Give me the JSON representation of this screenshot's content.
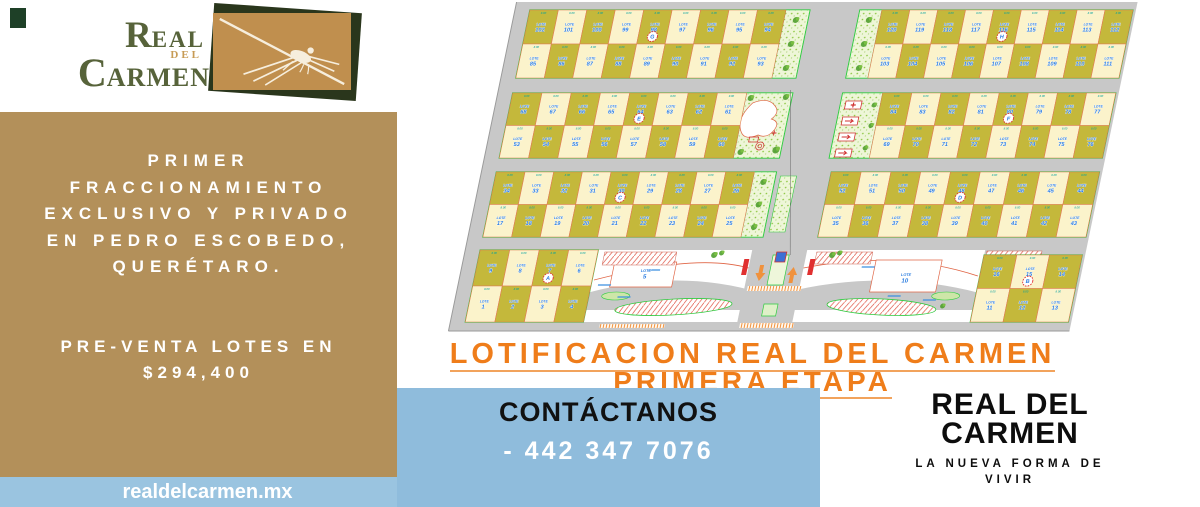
{
  "logo": {
    "line1_initial": "R",
    "line1_rest": "EAL",
    "del": "DEL",
    "line2_initial": "C",
    "line2_rest": "ARMEN"
  },
  "left_panel": {
    "headline": [
      "PRIMER",
      "FRACCIONAMIENTO",
      "EXCLUSIVO Y PRIVADO",
      "EN PEDRO ESCOBEDO,",
      "QUERÉTARO."
    ],
    "presale": [
      "PRE-VENTA LOTES EN",
      "$294,400"
    ]
  },
  "website": "realdelcarmen.mx",
  "plan_title": {
    "line1": "LOTIFICACION REAL DEL CARMEN",
    "line2": "PRIMERA ETAPA"
  },
  "contact": {
    "heading": "CONTÁCTANOS",
    "phone": "- 442 347 7076"
  },
  "brand_footer": {
    "line1": "REAL DEL",
    "line2": "CARMEN",
    "tagline_line1": "LA NUEVA FORMA DE",
    "tagline_line2": "VIVIR"
  },
  "accent_colors": {
    "tan_panel": "#b3905a",
    "blue_box": "#8fbcdc",
    "blue_strip": "#9ac4e0",
    "title_orange": "#ef7d1a",
    "logo_green": "#57633a",
    "logo_gold": "#c08f4e"
  },
  "site_plan": {
    "label_prefix": "LOTE",
    "dim": "8.00",
    "colors": {
      "road": "#c8c8c8",
      "olive": "#c4b83b",
      "cream": "#fbf3cb",
      "lot_border": "#e07b52",
      "block_border": "#2ecc40",
      "label_blue": "#2b7de0",
      "dim_teal": "#00a0a0",
      "marker_red": "#e03030"
    },
    "markers": {
      "7": "A",
      "15": "B",
      "30": "C",
      "48": "D",
      "64": "E",
      "80": "F",
      "98": "G",
      "116": "H"
    },
    "special": [
      {
        "num": "5",
        "x": 185,
        "y": 272
      },
      {
        "num": "10",
        "x": 446,
        "y": 276
      }
    ],
    "blocks": [
      {
        "x": 15,
        "y": 10,
        "w": 280,
        "h": 68,
        "top": [
          102,
          101,
          100,
          99,
          98,
          97,
          96,
          95,
          94
        ],
        "bottom": [
          85,
          86,
          87,
          88,
          89,
          90,
          91,
          92,
          93
        ],
        "strip": {
          "side": "right",
          "w": 24,
          "type": "trees"
        }
      },
      {
        "x": 345,
        "y": 10,
        "w": 273,
        "h": 68,
        "top": [
          120,
          119,
          118,
          117,
          116,
          115,
          114,
          113,
          112
        ],
        "bottom": [
          103,
          104,
          105,
          106,
          107,
          108,
          109,
          110,
          111
        ],
        "strip": {
          "side": "left",
          "w": 22,
          "type": "trees"
        }
      },
      {
        "x": 15,
        "y": 93,
        "w": 280,
        "h": 65,
        "top": [
          68,
          67,
          66,
          65,
          64,
          63,
          62,
          61
        ],
        "bottom": [
          53,
          54,
          55,
          56,
          57,
          58,
          59,
          60
        ],
        "strip": {
          "side": "right",
          "w": 46,
          "type": "park"
        }
      },
      {
        "x": 345,
        "y": 93,
        "w": 273,
        "h": 65,
        "top": [
          84,
          83,
          82,
          81,
          80,
          79,
          78,
          77
        ],
        "bottom": [
          69,
          70,
          71,
          72,
          73,
          74,
          75,
          76
        ],
        "strip": {
          "side": "left",
          "w": 40,
          "type": "amenity"
        }
      },
      {
        "x": 15,
        "y": 172,
        "w": 280,
        "h": 65,
        "top": [
          34,
          33,
          32,
          31,
          30,
          29,
          28,
          27,
          26
        ],
        "bottom": [
          17,
          18,
          19,
          20,
          21,
          22,
          23,
          24,
          25
        ],
        "strip": {
          "side": "right",
          "w": 22,
          "type": "trees"
        }
      },
      {
        "x": 350,
        "y": 172,
        "w": 268,
        "h": 65,
        "top": [
          52,
          51,
          50,
          49,
          48,
          47,
          46,
          45,
          44
        ],
        "bottom": [
          35,
          36,
          37,
          38,
          39,
          40,
          41,
          42,
          43
        ]
      },
      {
        "x": 15,
        "y": 250,
        "w": 118,
        "h": 72,
        "top": [
          9,
          8,
          7,
          6
        ],
        "bottom": [
          1,
          2,
          3,
          4
        ]
      },
      {
        "x": 520,
        "y": 255,
        "w": 98,
        "h": 67,
        "top": [
          16,
          15,
          14
        ],
        "bottom": [
          11,
          12,
          13
        ]
      }
    ]
  }
}
